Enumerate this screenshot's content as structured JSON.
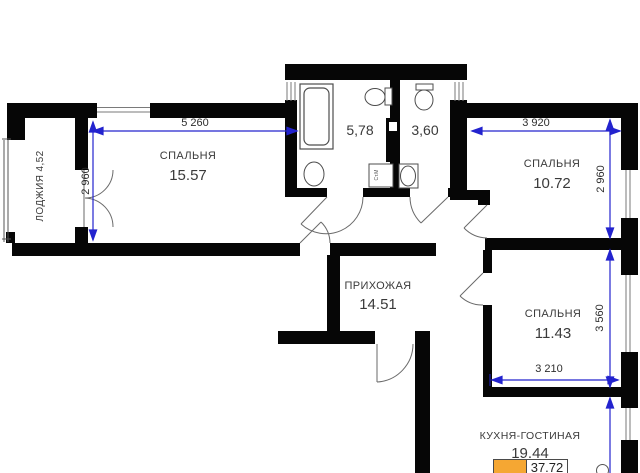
{
  "rooms": {
    "loggia": {
      "label": "ЛОДЖИЯ 4,52"
    },
    "bedroom1": {
      "name": "СПАЛЬНЯ",
      "area": "15.57"
    },
    "bath1": {
      "area": "5,78"
    },
    "bath2": {
      "area": "3,60"
    },
    "bedroom2": {
      "name": "СПАЛЬНЯ",
      "area": "10.72"
    },
    "hallway": {
      "name": "ПРИХОЖАЯ",
      "area": "14.51"
    },
    "bedroom3": {
      "name": "СПАЛЬНЯ",
      "area": "11.43"
    },
    "kitchen": {
      "name": "КУХНЯ-ГОСТИНАЯ",
      "area": "19.44"
    }
  },
  "dimensions": {
    "bedroom1_width": "5 260",
    "bedroom1_height": "2 960",
    "bedroom2_width": "3 920",
    "bedroom2_height": "2 960",
    "bedroom3_height": "3 560",
    "bedroom3_width": "3 210"
  },
  "fixtures": {
    "washing_machine": "Ст.М"
  },
  "legend": {
    "total_area": "37.72",
    "swatch_style": "background:#F5A733"
  },
  "colors": {
    "wall": "#060606",
    "dimension_line": "#2323CE",
    "text": "#3A3A3A",
    "highlight": "#F5A733"
  }
}
